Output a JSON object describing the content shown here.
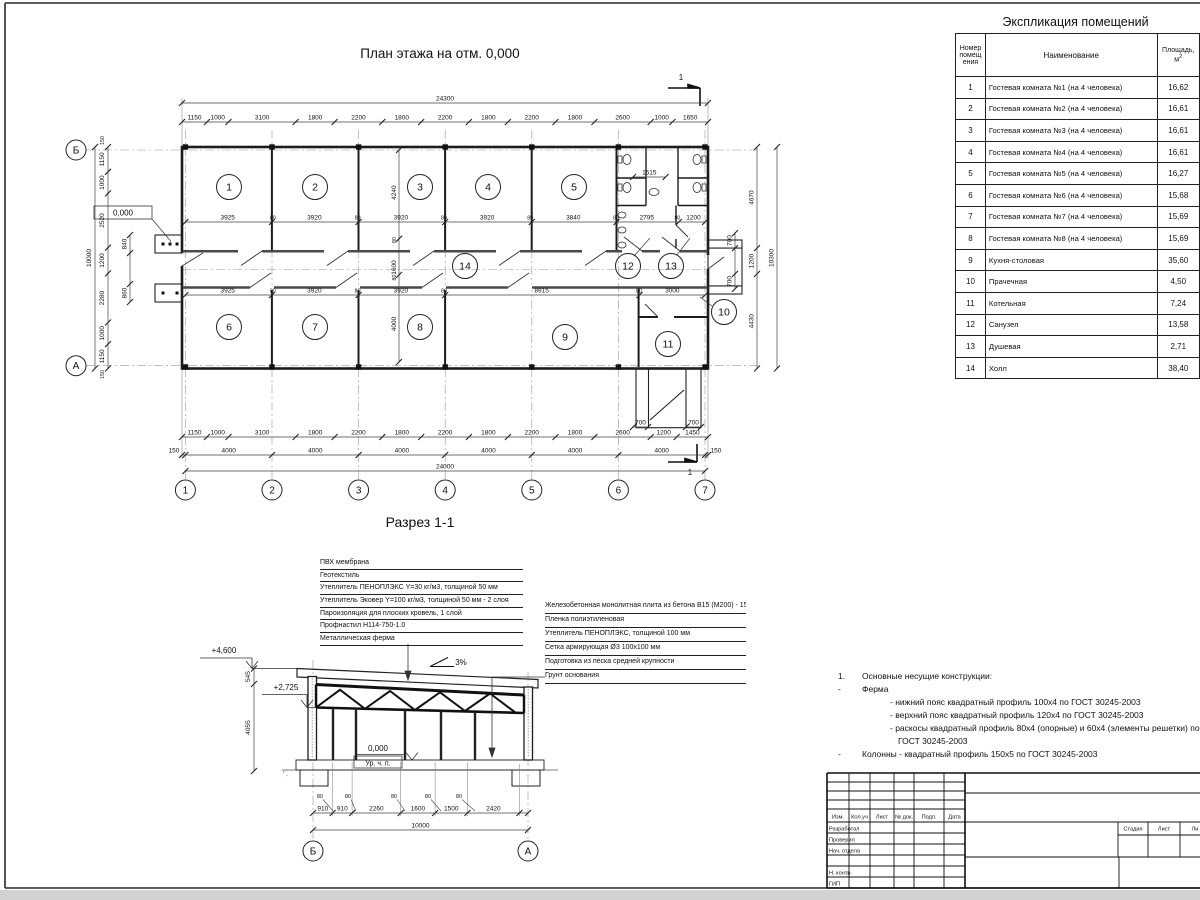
{
  "sheet": {
    "plan_title": "План этажа на отм. 0,000",
    "section_title": "Разрез 1-1",
    "table_title": "Экспликация помещений"
  },
  "plan": {
    "level_mark": "0,000",
    "section_cut_label": "1",
    "axes_cols": [
      "1",
      "2",
      "3",
      "4",
      "5",
      "6",
      "7"
    ],
    "axes_rows": [
      "Б",
      "А"
    ],
    "room_numbers": [
      "1",
      "2",
      "3",
      "4",
      "5",
      "6",
      "7",
      "8",
      "9",
      "10",
      "11",
      "12",
      "13",
      "14"
    ],
    "dims": {
      "top_overall": "24300",
      "top_row": [
        "1150",
        "1000",
        "3100",
        "1800",
        "2200",
        "1800",
        "2200",
        "1800",
        "2200",
        "1800",
        "2600",
        "1000",
        "1650"
      ],
      "bottom_row": [
        "1150",
        "1000",
        "3100",
        "1800",
        "2200",
        "1800",
        "2200",
        "1800",
        "2200",
        "1800",
        "2600",
        "1200",
        "1450"
      ],
      "bottom_axes": [
        "150",
        "4000",
        "4000",
        "4000",
        "4000",
        "4000",
        "4000",
        "150"
      ],
      "bottom_overall": "24000",
      "inner_top": [
        "3925",
        "80",
        "3920",
        "80",
        "3920",
        "80",
        "3920",
        "80",
        "3840",
        "80",
        "2795",
        "80",
        "1200"
      ],
      "inner_bottom": [
        "3925",
        "80",
        "3920",
        "80",
        "3920",
        "80",
        "8915",
        "80",
        "3000"
      ],
      "mid_vertical": [
        "4240",
        "80",
        "1600",
        "80",
        "4000"
      ],
      "left_row": [
        "1150",
        "1000",
        "2520",
        "1200",
        "2280",
        "1000",
        "1150"
      ],
      "left_inner": [
        "840",
        "860"
      ],
      "left_overall": "10000",
      "left_margins": [
        "150",
        "150"
      ],
      "right_row": [
        "4670",
        "1200",
        "4430"
      ],
      "right_inner": [
        "700",
        "700"
      ],
      "right_overall": "10300",
      "san_width": "1515",
      "porch_bottom": [
        "700",
        "700"
      ]
    }
  },
  "section": {
    "slope": "3%",
    "level_top": "+4,600",
    "level_truss": "+2,725",
    "level_floor": "0,000",
    "floor_note": "Ур. ч. п.",
    "axes": [
      "Б",
      "А"
    ],
    "dims_bottom": [
      "910",
      "910",
      "2260",
      "1600",
      "1500",
      "2420"
    ],
    "dim_overall": "10000",
    "dims_left": [
      "545",
      "4055"
    ],
    "col_width_labels": [
      "80",
      "80",
      "80",
      "80",
      "80"
    ],
    "roof_layers": [
      "ПВХ мембрана",
      "Геотекстиль",
      "Утеплитель ПЕНОПЛЭКС Y=30 кг/м3, толщиной 50 мм",
      "Утеплитель Эковер Y=100 кг/м3, толщиной 50 мм - 2 слоя",
      "Пароизоляция для плоских кровель, 1 слой",
      "Профнастил Н114-750-1.0",
      "Металлическая ферма"
    ],
    "floor_layers": [
      "Железобетонная монолитная плита из бетона В15 (М200) - 150 мм",
      "Пленка полиэтиленовая",
      "Утеплитель ПЕНОПЛЭКС, толщиной 100 мм",
      "Сетка армирующая Ø3 100х100 мм",
      "Подготовка из песка средней крупности",
      "Грунт основания"
    ]
  },
  "notes": {
    "n1_num": "1.",
    "n1": "Основные несущие конструкции:",
    "b1_marker": "-",
    "b1": "Ферма",
    "s1": "- нижний пояс квадратный профиль 100х4 по ГОСТ 30245-2003",
    "s2": "- верхний пояс квадратный профиль 120х4 по ГОСТ 30245-2003",
    "s3": "- раскосы квадратный профиль 80х4 (опорные) и 60х4 (элементы решетки) по",
    "s3b": "ГОСТ 30245-2003",
    "b2_marker": "-",
    "b2": "Колонны - квадратный профиль 150х5 по ГОСТ 30245-2003"
  },
  "room_table": {
    "col_num": "Номер помещ ения",
    "col_name": "Наименование",
    "area_1": "Площадь,",
    "area_2": "м",
    "area_sup": "2",
    "rows": [
      {
        "num": "1",
        "name": "Гостевая комната №1 (на 4 человека)",
        "area": "16,62"
      },
      {
        "num": "2",
        "name": "Гостевая комната №2 (на 4 человека)",
        "area": "16,61"
      },
      {
        "num": "3",
        "name": "Гостевая комната №3 (на 4 человека)",
        "area": "16,61"
      },
      {
        "num": "4",
        "name": "Гостевая комната №4 (на 4 человека)",
        "area": "16,61"
      },
      {
        "num": "5",
        "name": "Гостевая комната №5 (на 4 человека)",
        "area": "16,27"
      },
      {
        "num": "6",
        "name": "Гостевая комната №6 (на 4 человека)",
        "area": "15,68"
      },
      {
        "num": "7",
        "name": "Гостевая комната №7 (на 4 человека)",
        "area": "15,69"
      },
      {
        "num": "8",
        "name": "Гостевая комната №8 (на 4 человека)",
        "area": "15,69"
      },
      {
        "num": "9",
        "name": "Кухня-столовая",
        "area": "35,60"
      },
      {
        "num": "10",
        "name": "Прачечная",
        "area": "4,50"
      },
      {
        "num": "11",
        "name": "Котельная",
        "area": "7,24"
      },
      {
        "num": "12",
        "name": "Санузел",
        "area": "13,58"
      },
      {
        "num": "13",
        "name": "Душевая",
        "area": "2,71"
      },
      {
        "num": "14",
        "name": "Холл",
        "area": "38,40"
      }
    ]
  },
  "titleblock": {
    "cols": [
      "Изм.",
      "Кол.уч",
      "Лист",
      "№ док.",
      "Подп.",
      "Дата"
    ],
    "rows": [
      "Разработал",
      "Проверил",
      "Нач. отдела",
      "Н. контр.",
      "ГИП"
    ],
    "stage": "Стадия",
    "sheet": "Лист",
    "sheets": "Ли"
  }
}
